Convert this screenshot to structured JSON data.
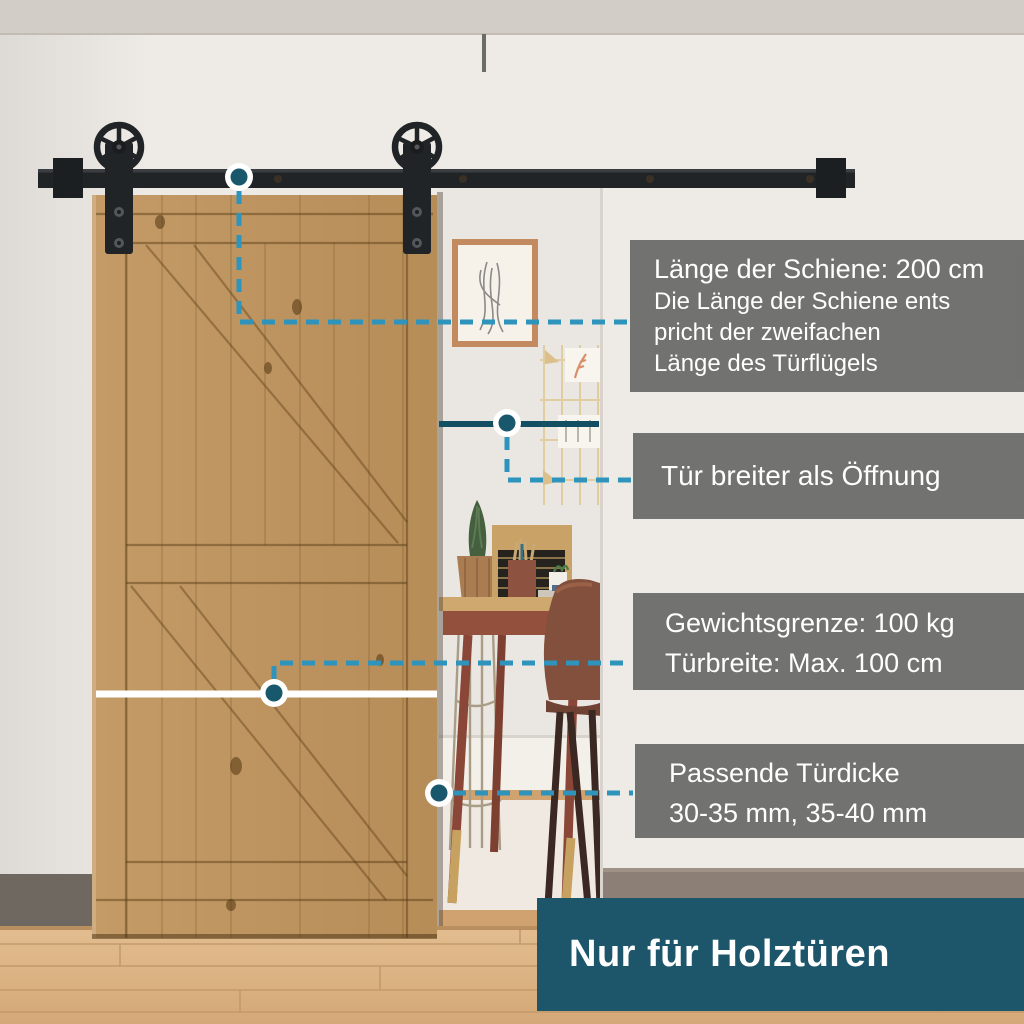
{
  "annotations": {
    "rail_length": {
      "title": "Länge der Schiene: 200 cm",
      "line1": "Die Länge der Schiene ents",
      "line2": "pricht der zweifachen",
      "line3": "Länge des Türflügels"
    },
    "door_wider": {
      "text": "Tür breiter als Öffnung"
    },
    "weight": {
      "line1": "Gewichtsgrenze: 100 kg",
      "line2": "Türbreite: Max. 100 cm"
    },
    "thickness": {
      "line1": "Passende Türdicke",
      "line2": "30-35 mm, 35-40 mm"
    },
    "footer": {
      "text": "Nur für Holztüren"
    }
  },
  "colors": {
    "accent_teal": "#1d566b",
    "dot_teal": "#19576d",
    "solid_line_teal": "#124f63",
    "dashed_blue": "#2f94bb",
    "note_gray": "#6c6c6c",
    "hardware_black": "#212426",
    "door_wood": "#c09862",
    "text_white": "#ffffff"
  }
}
